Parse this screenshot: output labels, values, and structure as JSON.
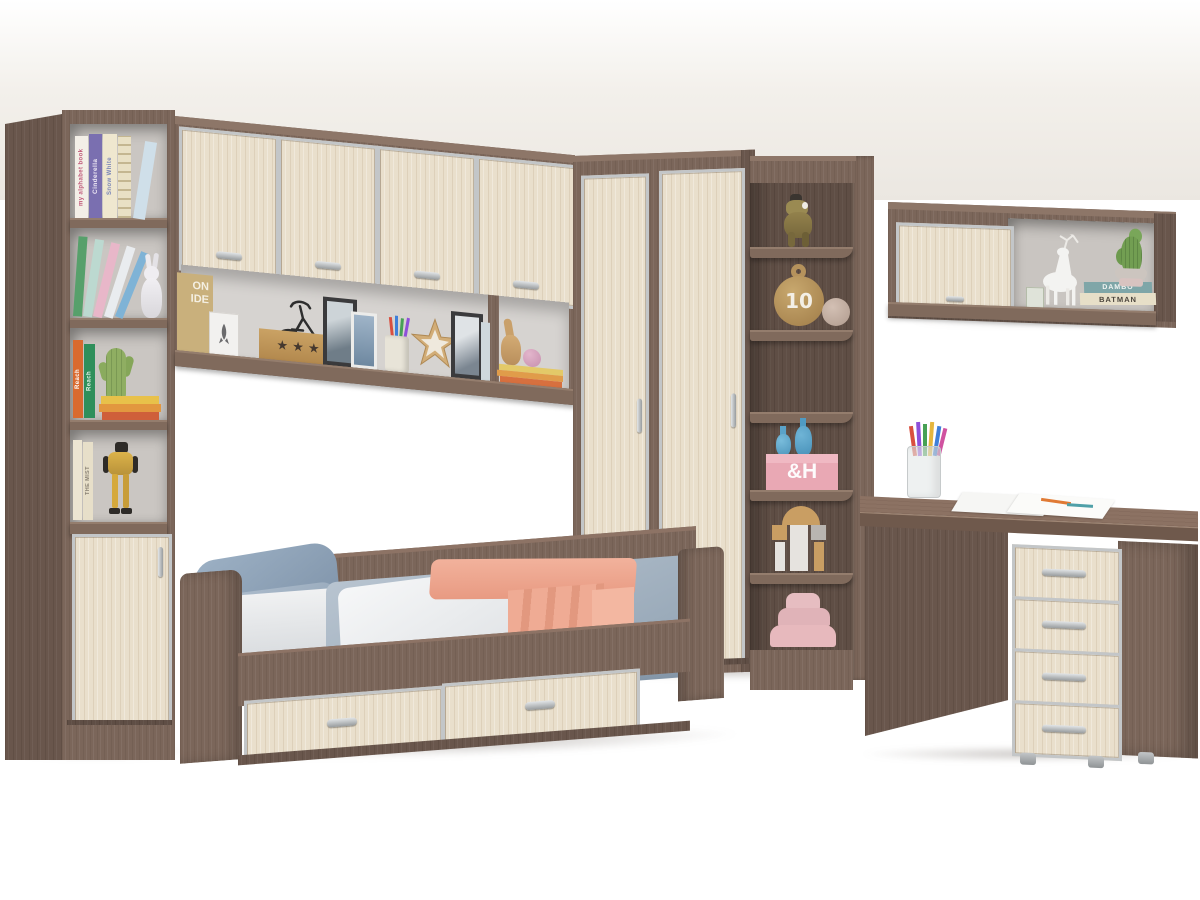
{
  "meta": {
    "subject": "children-bedroom-furniture-set-render"
  },
  "palette": {
    "wood_dark": "#7b665a",
    "wood_dark_side": "#69564c",
    "wood_dark_deep": "#5f4e45",
    "wood_light": "#e9dfcc",
    "frame_silver": "#c3c6c8",
    "wall": "#ffffff",
    "floor": "#f1eee9",
    "pillow_blue": "#8ea2b8",
    "duvet_gray": "#a9b8c6",
    "blanket_white": "#f0f2f3",
    "blanket_pink": "#eda28c"
  },
  "bookcase": {
    "books_top": [
      {
        "title": "my alphabet book"
      },
      {
        "title": "Cinderella"
      },
      {
        "title": "Snow White"
      }
    ],
    "books_mid": [
      {
        "title": "Reach"
      },
      {
        "title": "Reach"
      }
    ],
    "books_lower": [
      {
        "title": "THE MIST"
      }
    ]
  },
  "bridge": {
    "poster": {
      "line1": "ON",
      "line2": "IDE"
    },
    "star_box": {
      "stars": "★ ★ ★ ★"
    }
  },
  "corner": {
    "ball_label": "10",
    "box_label": "&H"
  },
  "wall_shelf": {
    "book_top": "DAMBO",
    "book_bottom": "BATMAN"
  }
}
